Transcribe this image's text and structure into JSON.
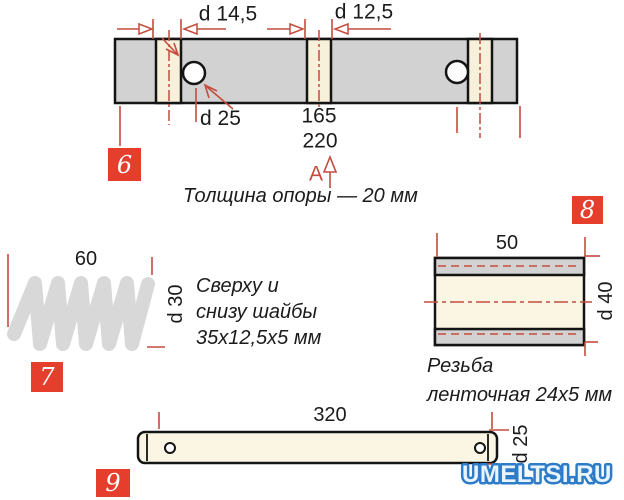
{
  "items": {
    "support": {
      "badge": "6",
      "dims": {
        "slot1": "d 14,5",
        "slot2": "d 12,5",
        "hole": "d 25",
        "len1": "165",
        "len2": "220"
      },
      "marker": "A",
      "note": "Толщина опоры — 20 мм"
    },
    "spring": {
      "badge": "7",
      "dims": {
        "length": "60",
        "diameter": "d 30"
      },
      "note": [
        "Сверху и",
        "снизу шайбы",
        "35х12,5х5 мм"
      ]
    },
    "bushing": {
      "badge": "8",
      "dims": {
        "length": "50",
        "diameter": "d 40"
      },
      "note": [
        "Резьба",
        "ленточная 24х5 мм"
      ]
    },
    "rod": {
      "badge": "9",
      "dims": {
        "length": "320",
        "diameter": "d 25"
      }
    }
  },
  "watermark": "UMELTSI.RU",
  "colors": {
    "dimension_red": "#c44c3e",
    "badge_red": "#e63e2d",
    "part_gray": "#d2d2d2",
    "part_cream": "#f7f1dc",
    "outline_black": "#141414",
    "watermark_blue": "#2e7bc8"
  }
}
